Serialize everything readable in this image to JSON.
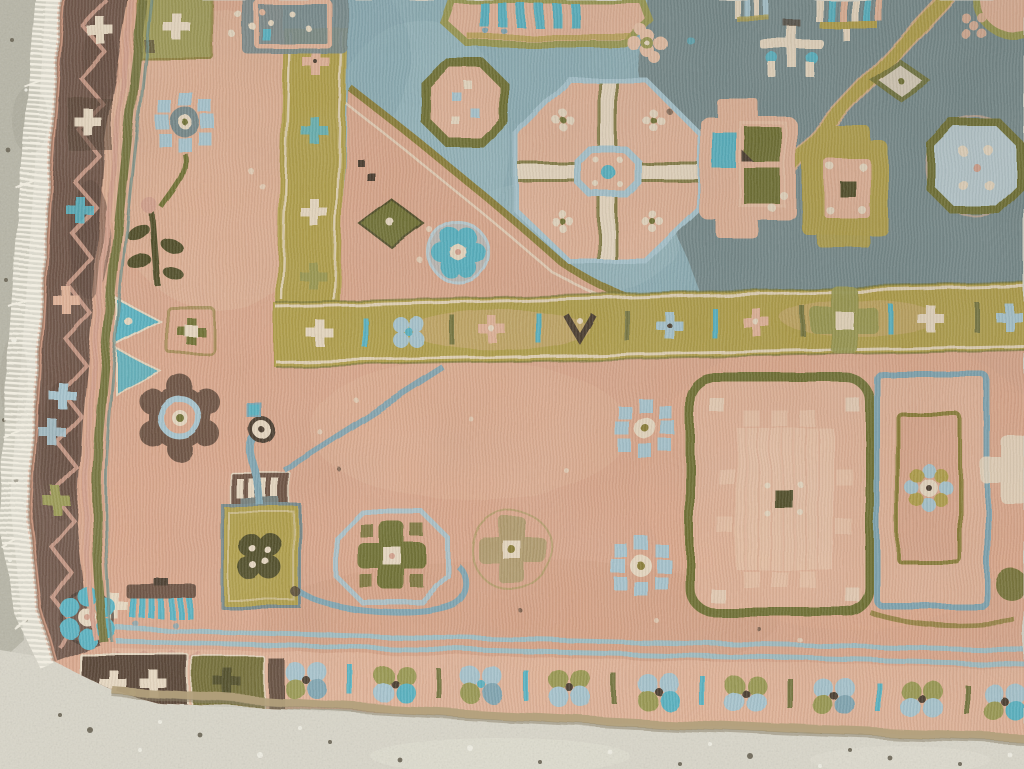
{
  "scene": {
    "description": "Top-down photograph of the corner of a vintage hand-knotted wool rug lying on a light speckled concrete floor; white fringe runs along the rug's left edge.",
    "subject": "vintage hand-knotted tribal rug, corner detail",
    "floor": "light speckled concrete",
    "fringe_side": "left"
  },
  "rug": {
    "field_colors": [
      "salmon-peach",
      "slate-blue",
      "grey-green"
    ],
    "regions": [
      {
        "name": "left-guard-border",
        "desc": "dark brown band with pink zigzag meander and small flower clusters"
      },
      {
        "name": "bottom-border",
        "desc": "peach band of paired blossom clusters between bar separators, dark flower boxes at the corner"
      },
      {
        "name": "inner-gold-frame",
        "desc": "mustard-gold band with rosettes and teal bar separators framing the blue field"
      },
      {
        "name": "blue-field",
        "desc": "slate-blue upper field with octagonal gul medallions, darker grey-green at right"
      },
      {
        "name": "peach-field",
        "desc": "salmon lower field with stylised flowers, rosettes and a spouted vessel motif"
      },
      {
        "name": "corner-spandrel",
        "desc": "peach diagonal spandrel cutting into the blue field"
      }
    ],
    "motifs": [
      "octagon-medallion-with-cross",
      "olive-ring-octagon",
      "pinwheel-rosette",
      "eight-petal-rosette",
      "four-petal-olive-flower",
      "khaki-flower",
      "square-medallion-stepped-center",
      "blue-panel-with-rosette",
      "spouted-vessel",
      "flower-tree",
      "teal-corner-rosette",
      "striped-tassel",
      "diagonal-gold-ray",
      "brown-ring-rosette",
      "teal-triangles"
    ]
  },
  "palette": {
    "floor_light": "#cfccbf",
    "floor_dark": "#b3b0a1",
    "floor_patch": "#a7a595",
    "speck_dark": "#6e6858",
    "speck_light": "#efede2",
    "fringe_white": "#f1ede1",
    "border_brown": "#6d5244",
    "border_brown_dark": "#523d2d",
    "zigzag_pink": "#d7a28c",
    "guard_olive": "#75743a",
    "field_peach": "#dfa98c",
    "field_peach_light": "#ecc3a6",
    "field_salmon_dark": "#d59a7e",
    "pink_soft": "#e6b598",
    "blue_field": "#8eb1b9",
    "blue_streak": "#a6c6cb",
    "slate_field": "#76898a",
    "gold_band": "#b4a147",
    "gold_dark": "#8b7d33",
    "olive": "#6e6f2e",
    "olive_light": "#9b9a4f",
    "olive_deep": "#4d4a22",
    "teal_bright": "#56b5c5",
    "blue_light": "#a9c8d2",
    "blue_mid": "#7fa7b4",
    "stripe_blue": "#9dc1c9",
    "cream": "#ecdcc3",
    "brown_ring": "#6b4f3e",
    "tan_khaki": "#b49d6d",
    "edge_tan": "#b2a07c",
    "dark_accent": "#463829",
    "pale_blue": "#bccfd4"
  }
}
